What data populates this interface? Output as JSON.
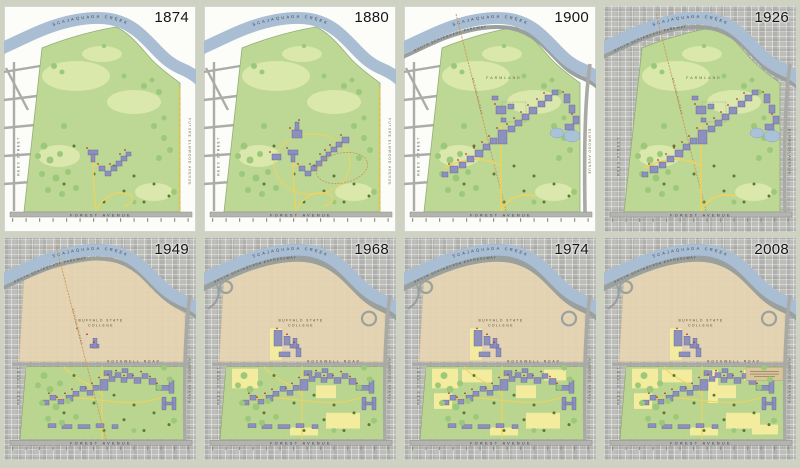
{
  "colors": {
    "background": "#cdd2c3",
    "site_green": "#bdd795",
    "meadow_light_green": "#dce9ae",
    "tree_green": "#9cc87a",
    "dark_tree_olive": "#5c7a31",
    "creek_blue": "#a9bed3",
    "pond_blue": "#a9c2d8",
    "road_gray": "#a9a9a5",
    "building_purple": "#8d90bd",
    "path_yellow": "#eed45e",
    "parking_yellow": "#f3ec9e",
    "campus_sepia": "#e6d5b2",
    "marker_red": "#c0392b",
    "railroad_orange": "#cf9a55"
  },
  "panels": [
    {
      "year": "1874",
      "era": "early",
      "photo": false,
      "expressway": false,
      "labels": {
        "creek": "SCAJAQUADA CREEK",
        "forest": "FOREST AVENUE",
        "left_street": "REES STREET",
        "right_street": "FUTURE ELMWOOD AVENUE"
      }
    },
    {
      "year": "1880",
      "era": "early",
      "photo": false,
      "expressway": false,
      "labels": {
        "creek": "SCAJAQUADA CREEK",
        "forest": "FOREST AVENUE",
        "left_street": "REES STREET",
        "right_street": "FUTURE ELMWOOD AVENUE"
      }
    },
    {
      "year": "1900",
      "era": "estate",
      "photo": false,
      "expressway": false,
      "labels": {
        "creek": "SCAJAQUADA CREEK",
        "parkway": "SOUTH SCAJAQUADA PARKWAY",
        "farmland": "FARMLAND",
        "railroad": "BELTLINE RAILROAD",
        "forest": "FOREST AVENUE",
        "left_street": "REES STREET",
        "right_street": "ELMWOOD AVENUE"
      }
    },
    {
      "year": "1926",
      "era": "estate",
      "photo": true,
      "expressway": false,
      "labels": {
        "creek": "SCAJAQUADA CREEK",
        "parkway": "SOUTH SCAJAQUADA PARKWAY",
        "farmland": "FARMLAND",
        "railroad": "BELTLINE RAILROAD",
        "forest": "FOREST AVENUE",
        "left_street": "REES STREET",
        "right_street": "ELMWOOD AVENUE"
      }
    },
    {
      "year": "1949",
      "era": "campus",
      "photo": true,
      "expressway": false,
      "labels": {
        "creek": "SCAJAQUADA CREEK",
        "parkway": "SOUTH SCAJAQUADA PARKWAY",
        "college1": "BUFFALO STATE",
        "college2": "COLLEGE",
        "rockwell": "ROCKWELL ROAD",
        "railroad": "BELTLINE RAILROAD",
        "forest": "FOREST AVENUE",
        "left_street": "REES STREET",
        "right_street": "ELMWOOD AVENUE"
      }
    },
    {
      "year": "1968",
      "era": "campus",
      "photo": true,
      "expressway": true,
      "labels": {
        "creek": "SCAJAQUADA CREEK",
        "parkway": "SOUTH SCAJAQUADA EXPRESSWAY",
        "college1": "BUFFALO STATE",
        "college2": "COLLEGE",
        "rockwell": "ROCKWELL ROAD",
        "forest": "FOREST AVENUE",
        "left_street": "REES STREET",
        "right_street": "ELMWOOD AVENUE"
      }
    },
    {
      "year": "1974",
      "era": "campus",
      "photo": true,
      "expressway": true,
      "labels": {
        "creek": "SCAJAQUADA CREEK",
        "parkway": "SOUTH SCAJAQUADA EXPRESSWAY",
        "college1": "BUFFALO STATE",
        "college2": "COLLEGE",
        "rockwell": "ROCKWELL ROAD",
        "forest": "FOREST AVENUE",
        "left_street": "REES STREET",
        "right_street": "ELMWOOD AVENUE"
      }
    },
    {
      "year": "2008",
      "era": "campus",
      "photo": true,
      "expressway": true,
      "labels": {
        "creek": "SCAJAQUADA CREEK",
        "parkway": "SOUTH SCAJAQUADA EXPRESSWAY",
        "college1": "BUFFALO STATE",
        "college2": "COLLEGE",
        "rockwell": "ROCKWELL ROAD",
        "forest": "FOREST AVENUE",
        "left_street": "REES STREET",
        "right_street": "ELMWOOD AVENUE"
      }
    }
  ]
}
